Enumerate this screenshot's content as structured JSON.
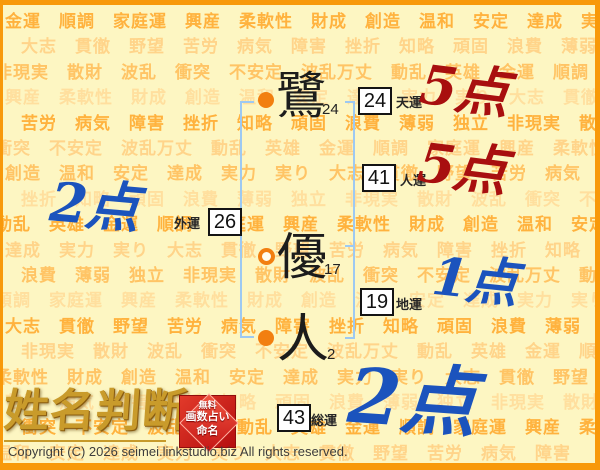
{
  "background": {
    "words": [
      "金運",
      "順調",
      "家庭運",
      "興産",
      "柔軟性",
      "財成",
      "創造",
      "温和",
      "安定",
      "達成",
      "実力",
      "実り",
      "大志",
      "貫徹",
      "野望",
      "苦労",
      "病気",
      "障害",
      "挫折",
      "知略",
      "頑固",
      "浪費",
      "薄弱",
      "独立",
      "非現実",
      "散財",
      "波乱",
      "衝突",
      "不安定",
      "波乱万丈",
      "動乱",
      "英雄"
    ],
    "shades": [
      "#ffb23e",
      "#ffd48a",
      "#ffc465",
      "#ffdf9e"
    ]
  },
  "name": {
    "chars": [
      {
        "char": "鷺",
        "strokes": "24"
      },
      {
        "char": "優",
        "strokes": "17"
      },
      {
        "char": "人",
        "strokes": "2"
      }
    ]
  },
  "fortunes": [
    {
      "value": "24",
      "label": "天運"
    },
    {
      "value": "41",
      "label": "人運"
    },
    {
      "value": "19",
      "label": "地運"
    },
    {
      "value": "26",
      "label": "外運"
    },
    {
      "value": "43",
      "label": "総運"
    }
  ],
  "scores": [
    {
      "for": "天運",
      "text": "5点",
      "color": "#a80f0f"
    },
    {
      "for": "人運",
      "text": "5点",
      "color": "#a80f0f"
    },
    {
      "for": "地運",
      "text": "1点",
      "color": "#1b53bd"
    },
    {
      "for": "外運",
      "text": "2点",
      "color": "#1b53bd"
    },
    {
      "for": "総運",
      "text": "2点",
      "color": "#1b53bd"
    }
  ],
  "logo": {
    "text": "姓名判断",
    "seal_lines": [
      "無料",
      "画数占い",
      "命名"
    ]
  },
  "footer": {
    "copyright": "Copyright (C) 2026 seimei.linkstudio.biz All rights reserved."
  },
  "colors": {
    "frame": "#f8990a",
    "page_bg": "#fdf6c2",
    "bracket": "#9dc9f2",
    "dot": "#f27f10",
    "score_red": "#a80f0f",
    "score_blue": "#1b53bd",
    "logo_gold": "#c99b2b",
    "seal_red": "#c51515"
  }
}
